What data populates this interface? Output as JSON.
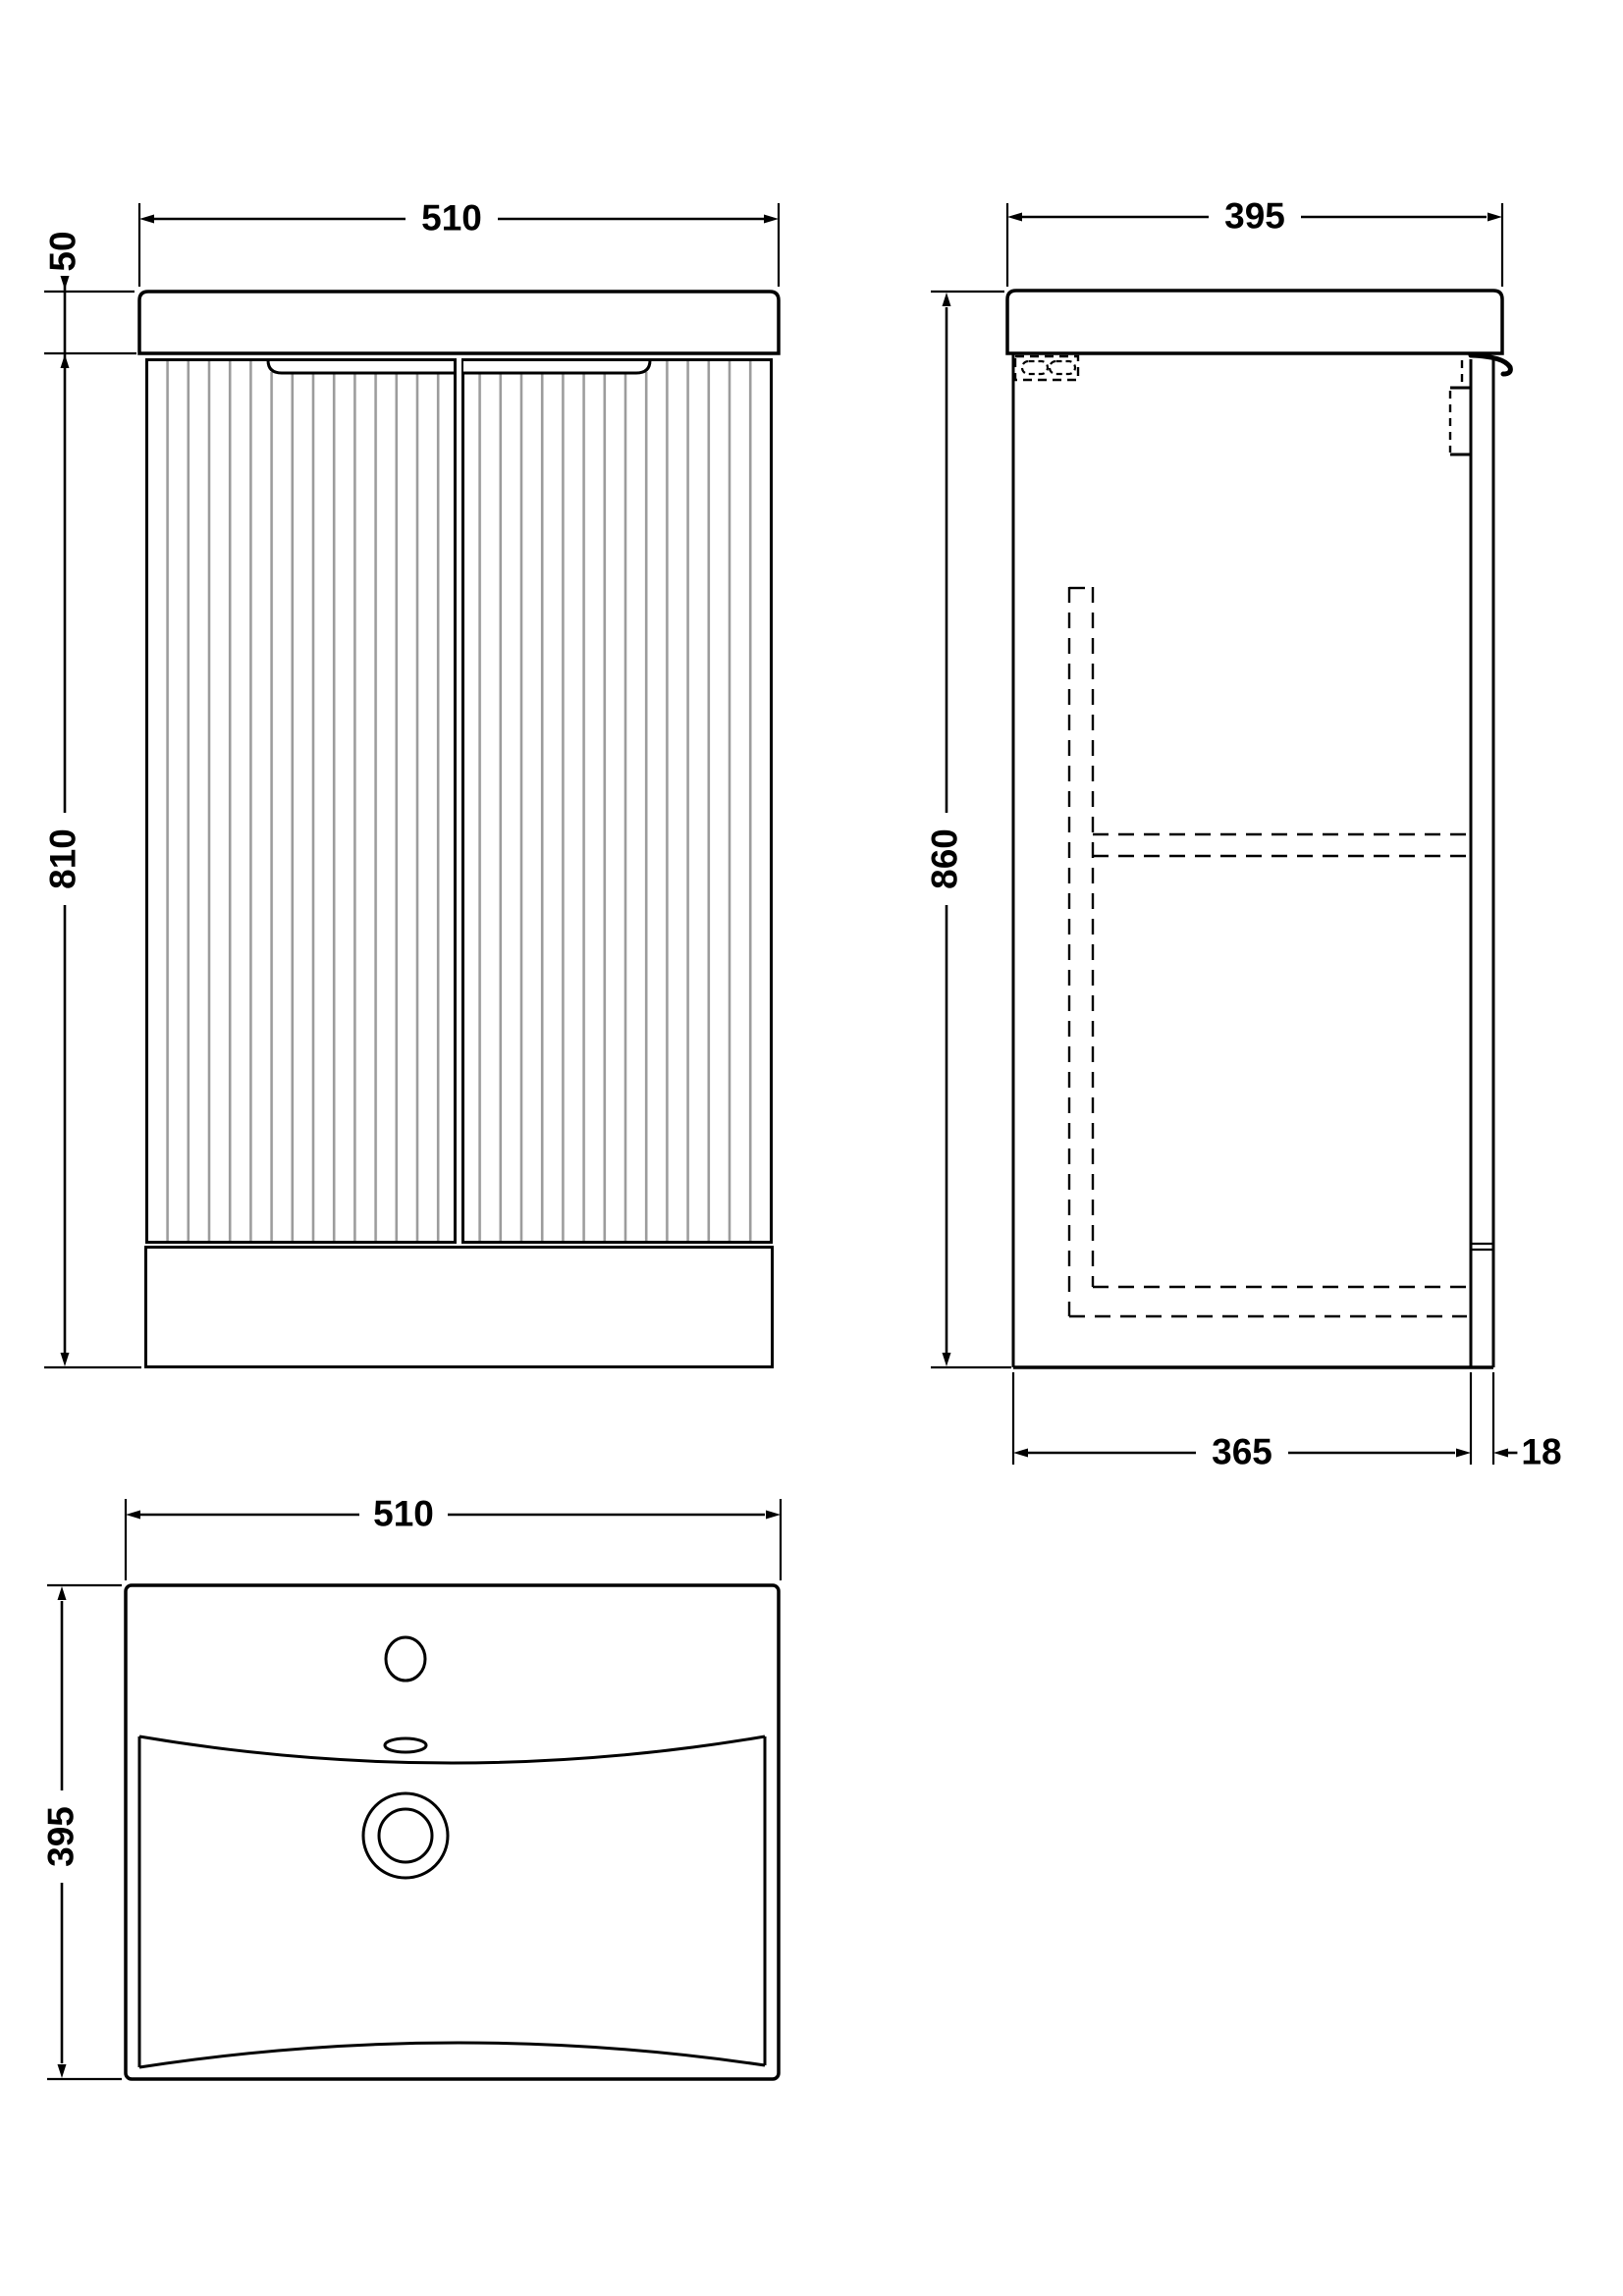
{
  "drawing_type": "bathroom vanity unit technical drawing, three orthographic views",
  "views": {
    "front": {
      "name": "front-elevation",
      "width": "510",
      "basin_height": "50",
      "cabinet_height": "810"
    },
    "side": {
      "name": "side-elevation",
      "depth": "395",
      "overall_height": "860",
      "carcass_depth": "365",
      "door_thickness": "18"
    },
    "plan": {
      "name": "basin-plan",
      "width": "510",
      "depth": "395"
    }
  },
  "colors": {
    "line": "#000000",
    "flute": "#9c9c9c",
    "background": "#ffffff"
  }
}
